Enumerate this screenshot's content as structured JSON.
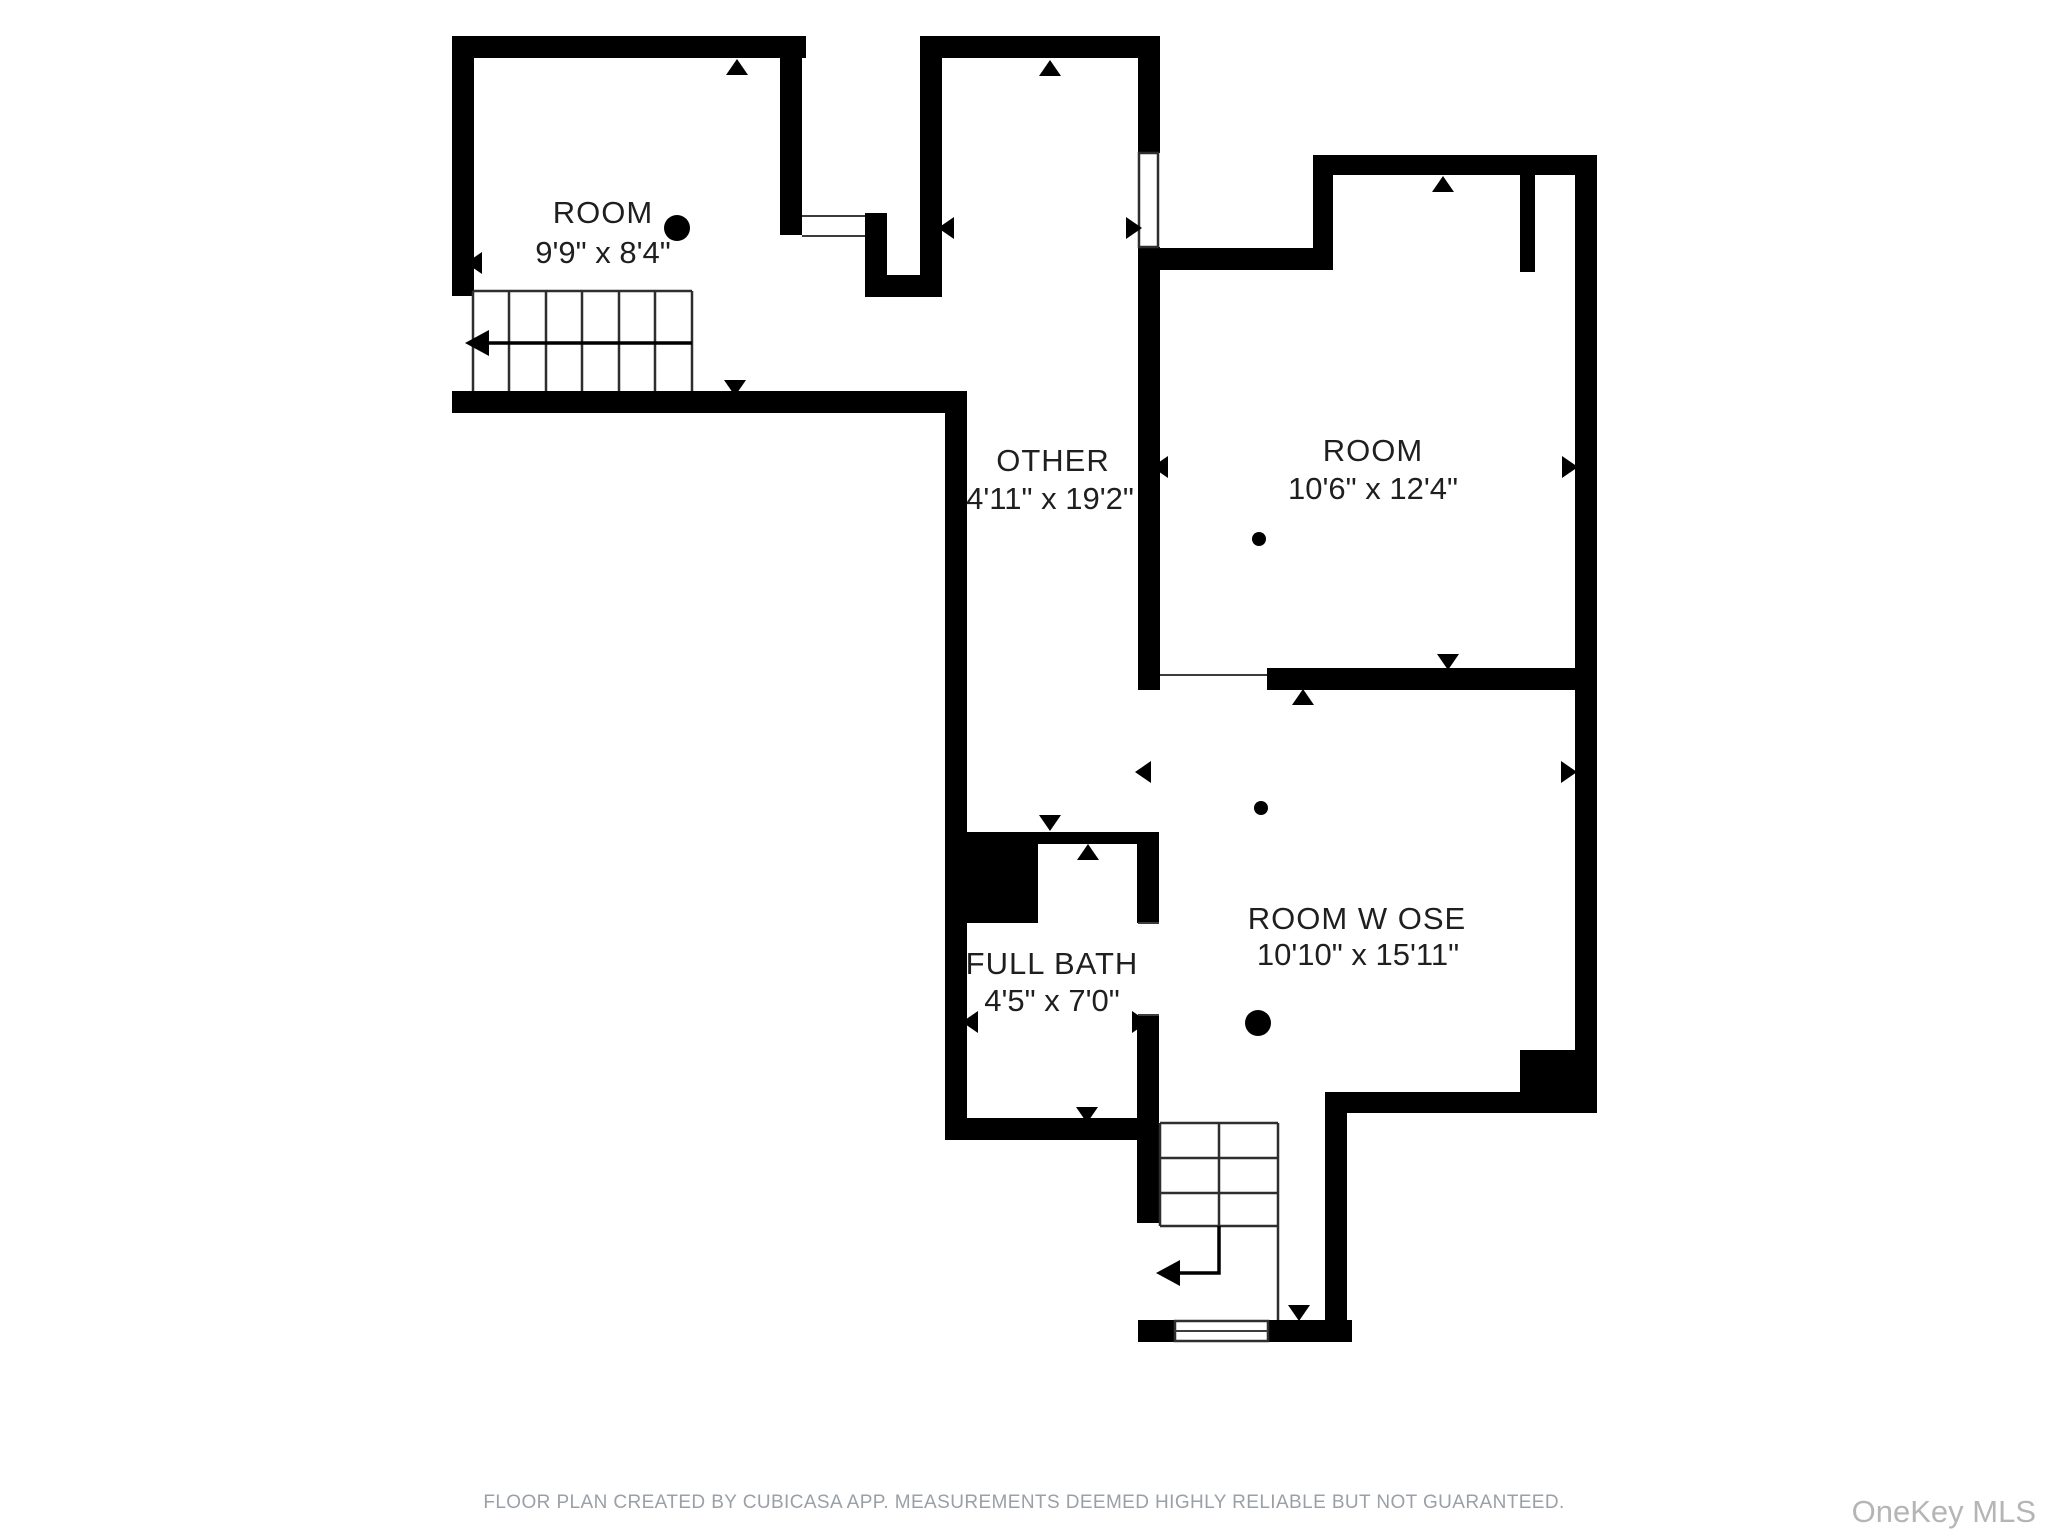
{
  "rooms": [
    {
      "name": "ROOM",
      "dims": "9'9\" x 8'4\""
    },
    {
      "name": "OTHER",
      "dims": "4'11\" x 19'2\""
    },
    {
      "name": "ROOM",
      "dims": "10'6\" x 12'4\""
    },
    {
      "name": "FULL BATH",
      "dims": "4'5\" x 7'0\""
    },
    {
      "name": "ROOM W OSE",
      "dims": "10'10\" x 15'11\""
    }
  ],
  "footer": "FLOOR PLAN CREATED BY CUBICASA APP. MEASUREMENTS DEEMED HIGHLY RELIABLE BUT NOT GUARANTEED.",
  "watermark": "OneKey MLS",
  "colors": {
    "wall": "#000000",
    "thin_line": "#3c3c3c",
    "label_text": "#1f1f1f",
    "footer_text": "#9aa0a6",
    "watermark_text": "#b5b5b5",
    "background": "#ffffff"
  }
}
